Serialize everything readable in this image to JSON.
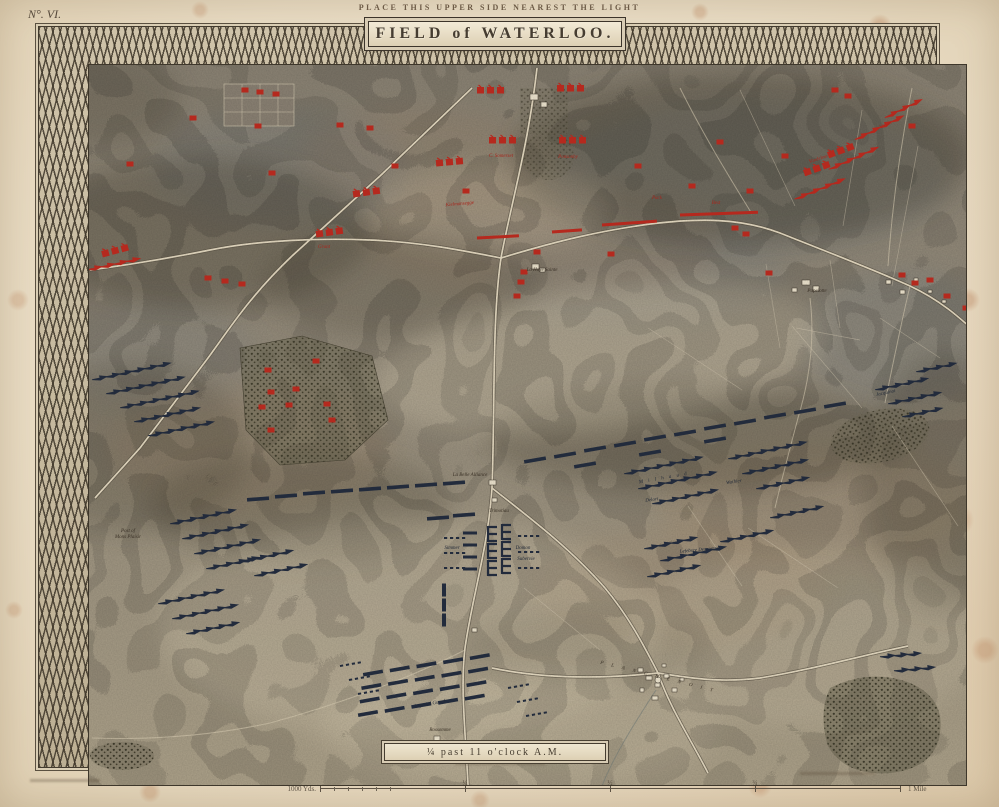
{
  "page": {
    "corner_label": "N°. VI.",
    "top_note": "PLACE THIS UPPER SIDE NEAREST THE LIGHT",
    "title": "FIELD of WATERLOO.",
    "time_caption": "¼ past 11 o'clock A.M."
  },
  "scale_bar": {
    "left_label": "1000 Yds.",
    "tick_labels": [
      "¼",
      "½",
      "¾"
    ],
    "right_label": "1 Mile"
  },
  "colors": {
    "allied": "#b5291e",
    "french": "#222b3c",
    "paper": "#eadbc3",
    "road": "#e7dcc3"
  },
  "map": {
    "places": [
      {
        "name": "La Haye Sainte",
        "x": 502,
        "y": 243,
        "fs": 5
      },
      {
        "name": "La Belle Alliance",
        "x": 430,
        "y": 448,
        "fs": 5.5
      },
      {
        "name": "Trimotiau",
        "x": 459,
        "y": 484,
        "fs": 4.5
      },
      {
        "name": "Papelotte",
        "x": 777,
        "y": 264,
        "fs": 4.5
      },
      {
        "name": "Rossomme",
        "x": 400,
        "y": 703,
        "fs": 4.5
      },
      {
        "name": "Post of",
        "x": 88,
        "y": 504,
        "fs": 4
      },
      {
        "name": "Mons Plaisir",
        "x": 88,
        "y": 510,
        "fs": 4
      },
      {
        "name": "P L A N C H E N O I T",
        "x": 618,
        "y": 650,
        "fs": 7,
        "rot": 14,
        "ls": 3.5
      }
    ],
    "allied_labels": [
      {
        "name": "Vivian",
        "x": 846,
        "y": 98,
        "rot": -24,
        "fs": 5
      },
      {
        "name": "Vandeleur",
        "x": 779,
        "y": 132,
        "rot": -18,
        "fs": 4.5
      },
      {
        "name": "Best",
        "x": 676,
        "y": 176,
        "fs": 4.5
      },
      {
        "name": "Pack",
        "x": 617,
        "y": 171,
        "fs": 4.5
      },
      {
        "name": "Ponsonby",
        "x": 528,
        "y": 130,
        "fs": 4.5
      },
      {
        "name": "C. Somerset",
        "x": 461,
        "y": 129,
        "fs": 4.5
      },
      {
        "name": "Grant",
        "x": 284,
        "y": 220,
        "fs": 4.5
      },
      {
        "name": "Kielmansegge",
        "x": 420,
        "y": 177,
        "rot": -5,
        "fs": 4
      }
    ],
    "french_labels": [
      {
        "name": "M i l h a u d",
        "x": 624,
        "y": 451,
        "rot": -10,
        "fs": 5,
        "ls": 2
      },
      {
        "name": "Wathier",
        "x": 694,
        "y": 455,
        "rot": -8,
        "fs": 4.5
      },
      {
        "name": "Delort",
        "x": 612,
        "y": 473,
        "rot": -8,
        "fs": 4.5
      },
      {
        "name": "Domon",
        "x": 483,
        "y": 521,
        "fs": 4.5
      },
      {
        "name": "Subervie",
        "x": 486,
        "y": 532,
        "fs": 4.5
      },
      {
        "name": "Simmer",
        "x": 412,
        "y": 521,
        "fs": 4.5
      },
      {
        "name": "Imperial Guard",
        "x": 390,
        "y": 677,
        "rot": -10,
        "fs": 6
      },
      {
        "name": "Lefebvre Desnoettes",
        "x": 660,
        "y": 523,
        "rot": -5,
        "fs": 4
      },
      {
        "name": "Jacquinot",
        "x": 846,
        "y": 366,
        "rot": -12,
        "fs": 4
      }
    ],
    "markers": [
      {
        "t": "rf3",
        "x": 437,
        "y": 62
      },
      {
        "t": "rf3",
        "x": 517,
        "y": 60
      },
      {
        "t": "rf3",
        "x": 449,
        "y": 112
      },
      {
        "t": "rf3",
        "x": 519,
        "y": 112
      },
      {
        "t": "rf3",
        "x": 396,
        "y": 135,
        "rot": -5
      },
      {
        "t": "rf3",
        "x": 313,
        "y": 166,
        "rot": -8
      },
      {
        "t": "rf3",
        "x": 276,
        "y": 206,
        "rot": -8
      },
      {
        "t": "rf3",
        "x": 62,
        "y": 226,
        "rot": -15
      },
      {
        "t": "rf3",
        "x": 788,
        "y": 127,
        "rot": -20
      },
      {
        "t": "rf3",
        "x": 764,
        "y": 145,
        "rot": -20
      },
      {
        "t": "rb",
        "x": 153,
        "y": 90
      },
      {
        "t": "rb",
        "x": 218,
        "y": 98
      },
      {
        "t": "rb",
        "x": 232,
        "y": 145
      },
      {
        "t": "rb",
        "x": 355,
        "y": 138
      },
      {
        "t": "rb",
        "x": 426,
        "y": 163
      },
      {
        "t": "rb",
        "x": 300,
        "y": 97
      },
      {
        "t": "rb",
        "x": 330,
        "y": 100
      },
      {
        "t": "rb",
        "x": 598,
        "y": 138
      },
      {
        "t": "rb",
        "x": 795,
        "y": 62
      },
      {
        "t": "rb",
        "x": 808,
        "y": 68
      },
      {
        "t": "rb",
        "x": 872,
        "y": 98
      },
      {
        "t": "rb",
        "x": 497,
        "y": 224
      },
      {
        "t": "rb",
        "x": 484,
        "y": 244
      },
      {
        "t": "rb",
        "x": 481,
        "y": 254
      },
      {
        "t": "rb",
        "x": 477,
        "y": 268
      },
      {
        "t": "rb",
        "x": 571,
        "y": 226
      },
      {
        "t": "rb",
        "x": 652,
        "y": 158
      },
      {
        "t": "rb",
        "x": 680,
        "y": 114
      },
      {
        "t": "rb",
        "x": 710,
        "y": 163
      },
      {
        "t": "rb",
        "x": 729,
        "y": 245
      },
      {
        "t": "rb",
        "x": 745,
        "y": 128
      },
      {
        "t": "rb",
        "x": 695,
        "y": 200
      },
      {
        "t": "rb",
        "x": 706,
        "y": 206
      },
      {
        "t": "rb",
        "x": 890,
        "y": 252
      },
      {
        "t": "rb",
        "x": 907,
        "y": 268
      },
      {
        "t": "rb",
        "x": 926,
        "y": 280
      },
      {
        "t": "rb",
        "x": 941,
        "y": 292
      },
      {
        "t": "rb",
        "x": 862,
        "y": 247
      },
      {
        "t": "rb",
        "x": 875,
        "y": 255
      },
      {
        "t": "rb",
        "x": 228,
        "y": 342
      },
      {
        "t": "rb",
        "x": 256,
        "y": 361
      },
      {
        "t": "rb",
        "x": 231,
        "y": 364
      },
      {
        "t": "rb",
        "x": 222,
        "y": 379
      },
      {
        "t": "rb",
        "x": 249,
        "y": 377
      },
      {
        "t": "rb",
        "x": 276,
        "y": 333
      },
      {
        "t": "rb",
        "x": 287,
        "y": 376
      },
      {
        "t": "rb",
        "x": 292,
        "y": 392
      },
      {
        "t": "rb",
        "x": 231,
        "y": 402
      },
      {
        "t": "rb",
        "x": 205,
        "y": 62
      },
      {
        "t": "rb",
        "x": 220,
        "y": 64
      },
      {
        "t": "rb",
        "x": 236,
        "y": 66
      },
      {
        "t": "rb",
        "x": 168,
        "y": 250
      },
      {
        "t": "rb",
        "x": 185,
        "y": 253
      },
      {
        "t": "rb",
        "x": 202,
        "y": 256
      },
      {
        "t": "rb",
        "x": 90,
        "y": 136
      },
      {
        "t": "rl",
        "x": 562,
        "y": 197,
        "len": 55,
        "rot": -4
      },
      {
        "t": "rl",
        "x": 640,
        "y": 187,
        "len": 78,
        "rot": -2
      },
      {
        "t": "rl",
        "x": 512,
        "y": 204,
        "len": 30,
        "rot": -4
      },
      {
        "t": "rl",
        "x": 437,
        "y": 210,
        "len": 42,
        "rot": -3
      },
      {
        "t": "ra",
        "x": 762,
        "y": 168,
        "n": 4,
        "rot": -22
      },
      {
        "t": "ra",
        "x": 796,
        "y": 138,
        "n": 4,
        "rot": -24
      },
      {
        "t": "ra",
        "x": 822,
        "y": 108,
        "n": 4,
        "rot": -26
      },
      {
        "t": "ra",
        "x": 852,
        "y": 86,
        "n": 3,
        "rot": -26
      },
      {
        "t": "ra",
        "x": 55,
        "y": 240,
        "n": 4,
        "rot": -12
      },
      {
        "t": "db",
        "x": 495,
        "y": 432,
        "rot": -10
      },
      {
        "t": "db",
        "x": 525,
        "y": 427,
        "rot": -10
      },
      {
        "t": "db",
        "x": 555,
        "y": 421,
        "rot": -10
      },
      {
        "t": "db",
        "x": 585,
        "y": 416,
        "rot": -10
      },
      {
        "t": "db",
        "x": 615,
        "y": 410,
        "rot": -10
      },
      {
        "t": "db",
        "x": 645,
        "y": 405,
        "rot": -10
      },
      {
        "t": "db",
        "x": 675,
        "y": 399,
        "rot": -10
      },
      {
        "t": "db",
        "x": 705,
        "y": 394,
        "rot": -10
      },
      {
        "t": "db",
        "x": 735,
        "y": 388,
        "rot": -10
      },
      {
        "t": "db",
        "x": 765,
        "y": 383,
        "rot": -10
      },
      {
        "t": "db",
        "x": 795,
        "y": 377,
        "rot": -10
      },
      {
        "t": "db",
        "x": 545,
        "y": 437,
        "rot": -10
      },
      {
        "t": "db",
        "x": 610,
        "y": 425,
        "rot": -10
      },
      {
        "t": "db",
        "x": 675,
        "y": 412,
        "rot": -10
      },
      {
        "t": "db",
        "x": 218,
        "y": 471,
        "rot": -4
      },
      {
        "t": "db",
        "x": 246,
        "y": 468,
        "rot": -4
      },
      {
        "t": "db",
        "x": 274,
        "y": 465,
        "rot": -4
      },
      {
        "t": "db",
        "x": 302,
        "y": 463,
        "rot": -4
      },
      {
        "t": "db",
        "x": 330,
        "y": 461,
        "rot": -4
      },
      {
        "t": "db",
        "x": 358,
        "y": 459,
        "rot": -4
      },
      {
        "t": "db",
        "x": 386,
        "y": 457,
        "rot": -4
      },
      {
        "t": "db",
        "x": 414,
        "y": 455,
        "rot": -4
      },
      {
        "t": "db",
        "x": 398,
        "y": 490,
        "rot": -4
      },
      {
        "t": "db",
        "x": 424,
        "y": 487,
        "rot": -4
      },
      {
        "t": "da",
        "x": 60,
        "y": 350,
        "n": 6,
        "rot": -12
      },
      {
        "t": "da",
        "x": 74,
        "y": 364,
        "n": 6,
        "rot": -12
      },
      {
        "t": "da",
        "x": 88,
        "y": 378,
        "n": 6,
        "rot": -12
      },
      {
        "t": "da",
        "x": 102,
        "y": 392,
        "n": 5,
        "rot": -12
      },
      {
        "t": "da",
        "x": 116,
        "y": 406,
        "n": 5,
        "rot": -12
      },
      {
        "t": "da",
        "x": 138,
        "y": 494,
        "n": 5,
        "rot": -12
      },
      {
        "t": "da",
        "x": 150,
        "y": 509,
        "n": 5,
        "rot": -12
      },
      {
        "t": "da",
        "x": 162,
        "y": 524,
        "n": 5,
        "rot": -12
      },
      {
        "t": "da",
        "x": 174,
        "y": 539,
        "n": 4,
        "rot": -12
      },
      {
        "t": "da",
        "x": 208,
        "y": 532,
        "n": 4,
        "rot": -12
      },
      {
        "t": "da",
        "x": 222,
        "y": 546,
        "n": 4,
        "rot": -12
      },
      {
        "t": "da",
        "x": 126,
        "y": 574,
        "n": 5,
        "rot": -12
      },
      {
        "t": "da",
        "x": 140,
        "y": 589,
        "n": 5,
        "rot": -12
      },
      {
        "t": "da",
        "x": 154,
        "y": 604,
        "n": 4,
        "rot": -12
      },
      {
        "t": "da",
        "x": 592,
        "y": 444,
        "n": 6,
        "rot": -12
      },
      {
        "t": "da",
        "x": 606,
        "y": 459,
        "n": 6,
        "rot": -12
      },
      {
        "t": "da",
        "x": 620,
        "y": 474,
        "n": 5,
        "rot": -12
      },
      {
        "t": "da",
        "x": 696,
        "y": 429,
        "n": 6,
        "rot": -12
      },
      {
        "t": "da",
        "x": 710,
        "y": 444,
        "n": 5,
        "rot": -12
      },
      {
        "t": "da",
        "x": 724,
        "y": 459,
        "n": 4,
        "rot": -12
      },
      {
        "t": "da",
        "x": 612,
        "y": 519,
        "n": 4,
        "rot": -12
      },
      {
        "t": "da",
        "x": 628,
        "y": 531,
        "n": 5,
        "rot": -12
      },
      {
        "t": "da",
        "x": 688,
        "y": 512,
        "n": 4,
        "rot": -12
      },
      {
        "t": "da",
        "x": 738,
        "y": 488,
        "n": 4,
        "rot": -12
      },
      {
        "t": "da",
        "x": 615,
        "y": 547,
        "n": 4,
        "rot": -12
      },
      {
        "t": "da",
        "x": 843,
        "y": 360,
        "n": 4,
        "rot": -12
      },
      {
        "t": "da",
        "x": 856,
        "y": 374,
        "n": 4,
        "rot": -12
      },
      {
        "t": "da",
        "x": 870,
        "y": 387,
        "n": 3,
        "rot": -12
      },
      {
        "t": "da",
        "x": 884,
        "y": 342,
        "n": 3,
        "rot": -12
      },
      {
        "t": "da",
        "x": 848,
        "y": 628,
        "n": 3,
        "rot": -5
      },
      {
        "t": "da",
        "x": 862,
        "y": 642,
        "n": 3,
        "rot": -5
      },
      {
        "t": "ticks",
        "x": 404,
        "y": 510,
        "n": 4
      },
      {
        "t": "ticks",
        "x": 404,
        "y": 525,
        "n": 4
      },
      {
        "t": "ticks",
        "x": 404,
        "y": 540,
        "n": 4
      },
      {
        "t": "ticks",
        "x": 478,
        "y": 508,
        "n": 4
      },
      {
        "t": "ticks",
        "x": 478,
        "y": 524,
        "n": 4
      },
      {
        "t": "ticks",
        "x": 478,
        "y": 540,
        "n": 4
      },
      {
        "t": "ticks",
        "x": 300,
        "y": 638,
        "n": 4,
        "rot": -10
      },
      {
        "t": "ticks",
        "x": 309,
        "y": 652,
        "n": 4,
        "rot": -10
      },
      {
        "t": "ticks",
        "x": 318,
        "y": 666,
        "n": 4,
        "rot": -10
      },
      {
        "t": "ticks",
        "x": 468,
        "y": 660,
        "n": 4,
        "rot": -10
      },
      {
        "t": "ticks",
        "x": 477,
        "y": 674,
        "n": 4,
        "rot": -10
      },
      {
        "t": "ticks",
        "x": 486,
        "y": 688,
        "n": 4,
        "rot": -10
      },
      {
        "t": "db2",
        "x": 430,
        "y": 505
      },
      {
        "t": "db2",
        "x": 430,
        "y": 517
      },
      {
        "t": "db2",
        "x": 430,
        "y": 529
      },
      {
        "t": "db2",
        "x": 430,
        "y": 541
      },
      {
        "t": "dc",
        "x": 448,
        "y": 506
      },
      {
        "t": "dc",
        "x": 448,
        "y": 523
      },
      {
        "t": "dc",
        "x": 448,
        "y": 540
      },
      {
        "t": "dc",
        "x": 462,
        "y": 504
      },
      {
        "t": "dc",
        "x": 462,
        "y": 521
      },
      {
        "t": "dc",
        "x": 462,
        "y": 538
      },
      {
        "t": "dvb",
        "x": 404,
        "y": 562
      },
      {
        "t": "dvb",
        "x": 404,
        "y": 577
      },
      {
        "t": "dvb",
        "x": 404,
        "y": 592
      },
      {
        "t": "grid",
        "x": 333,
        "y": 645,
        "rows": 4,
        "cols": 5,
        "dx": 27,
        "dy": 13,
        "rot": -10
      }
    ]
  }
}
